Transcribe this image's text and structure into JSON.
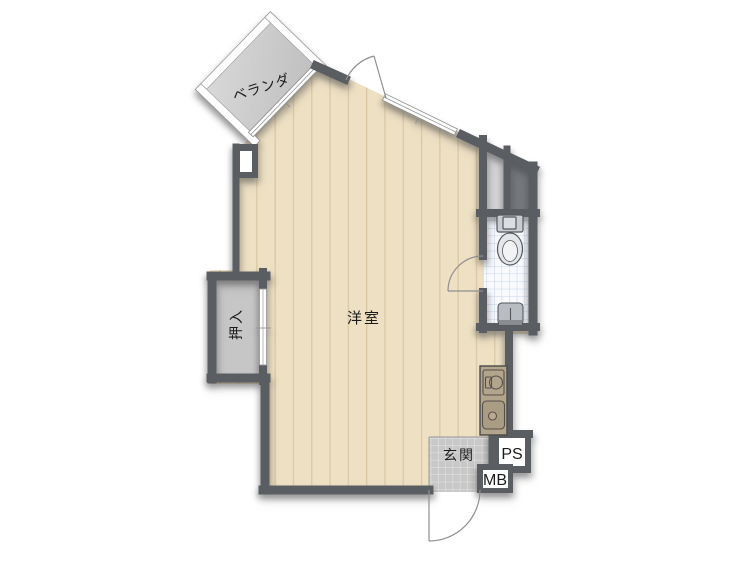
{
  "labels": {
    "balcony": "ベランダ",
    "main_room": "洋室",
    "closet": "押入",
    "entrance": "玄関",
    "pipe_space": "PS",
    "meter_box": "MB"
  },
  "colors": {
    "wall": "#5a5e63",
    "wood_floor": "#eee0c3",
    "wood_stripe": "#dbc9a6",
    "veranda_floor": "#cccccc",
    "closet_floor": "#c6c6c6",
    "toilet_tile_bg": "#f8fafd",
    "toilet_tile_grid": "#c5d3e8",
    "entrance_tile": "#c8c8c8",
    "entrance_tile_grid": "#e7e7e7",
    "counter": "#b3a58b",
    "shaft_dark": "#75797e",
    "shaft_light": "#d4d4d4",
    "door_arc": "#8f8f8f"
  }
}
